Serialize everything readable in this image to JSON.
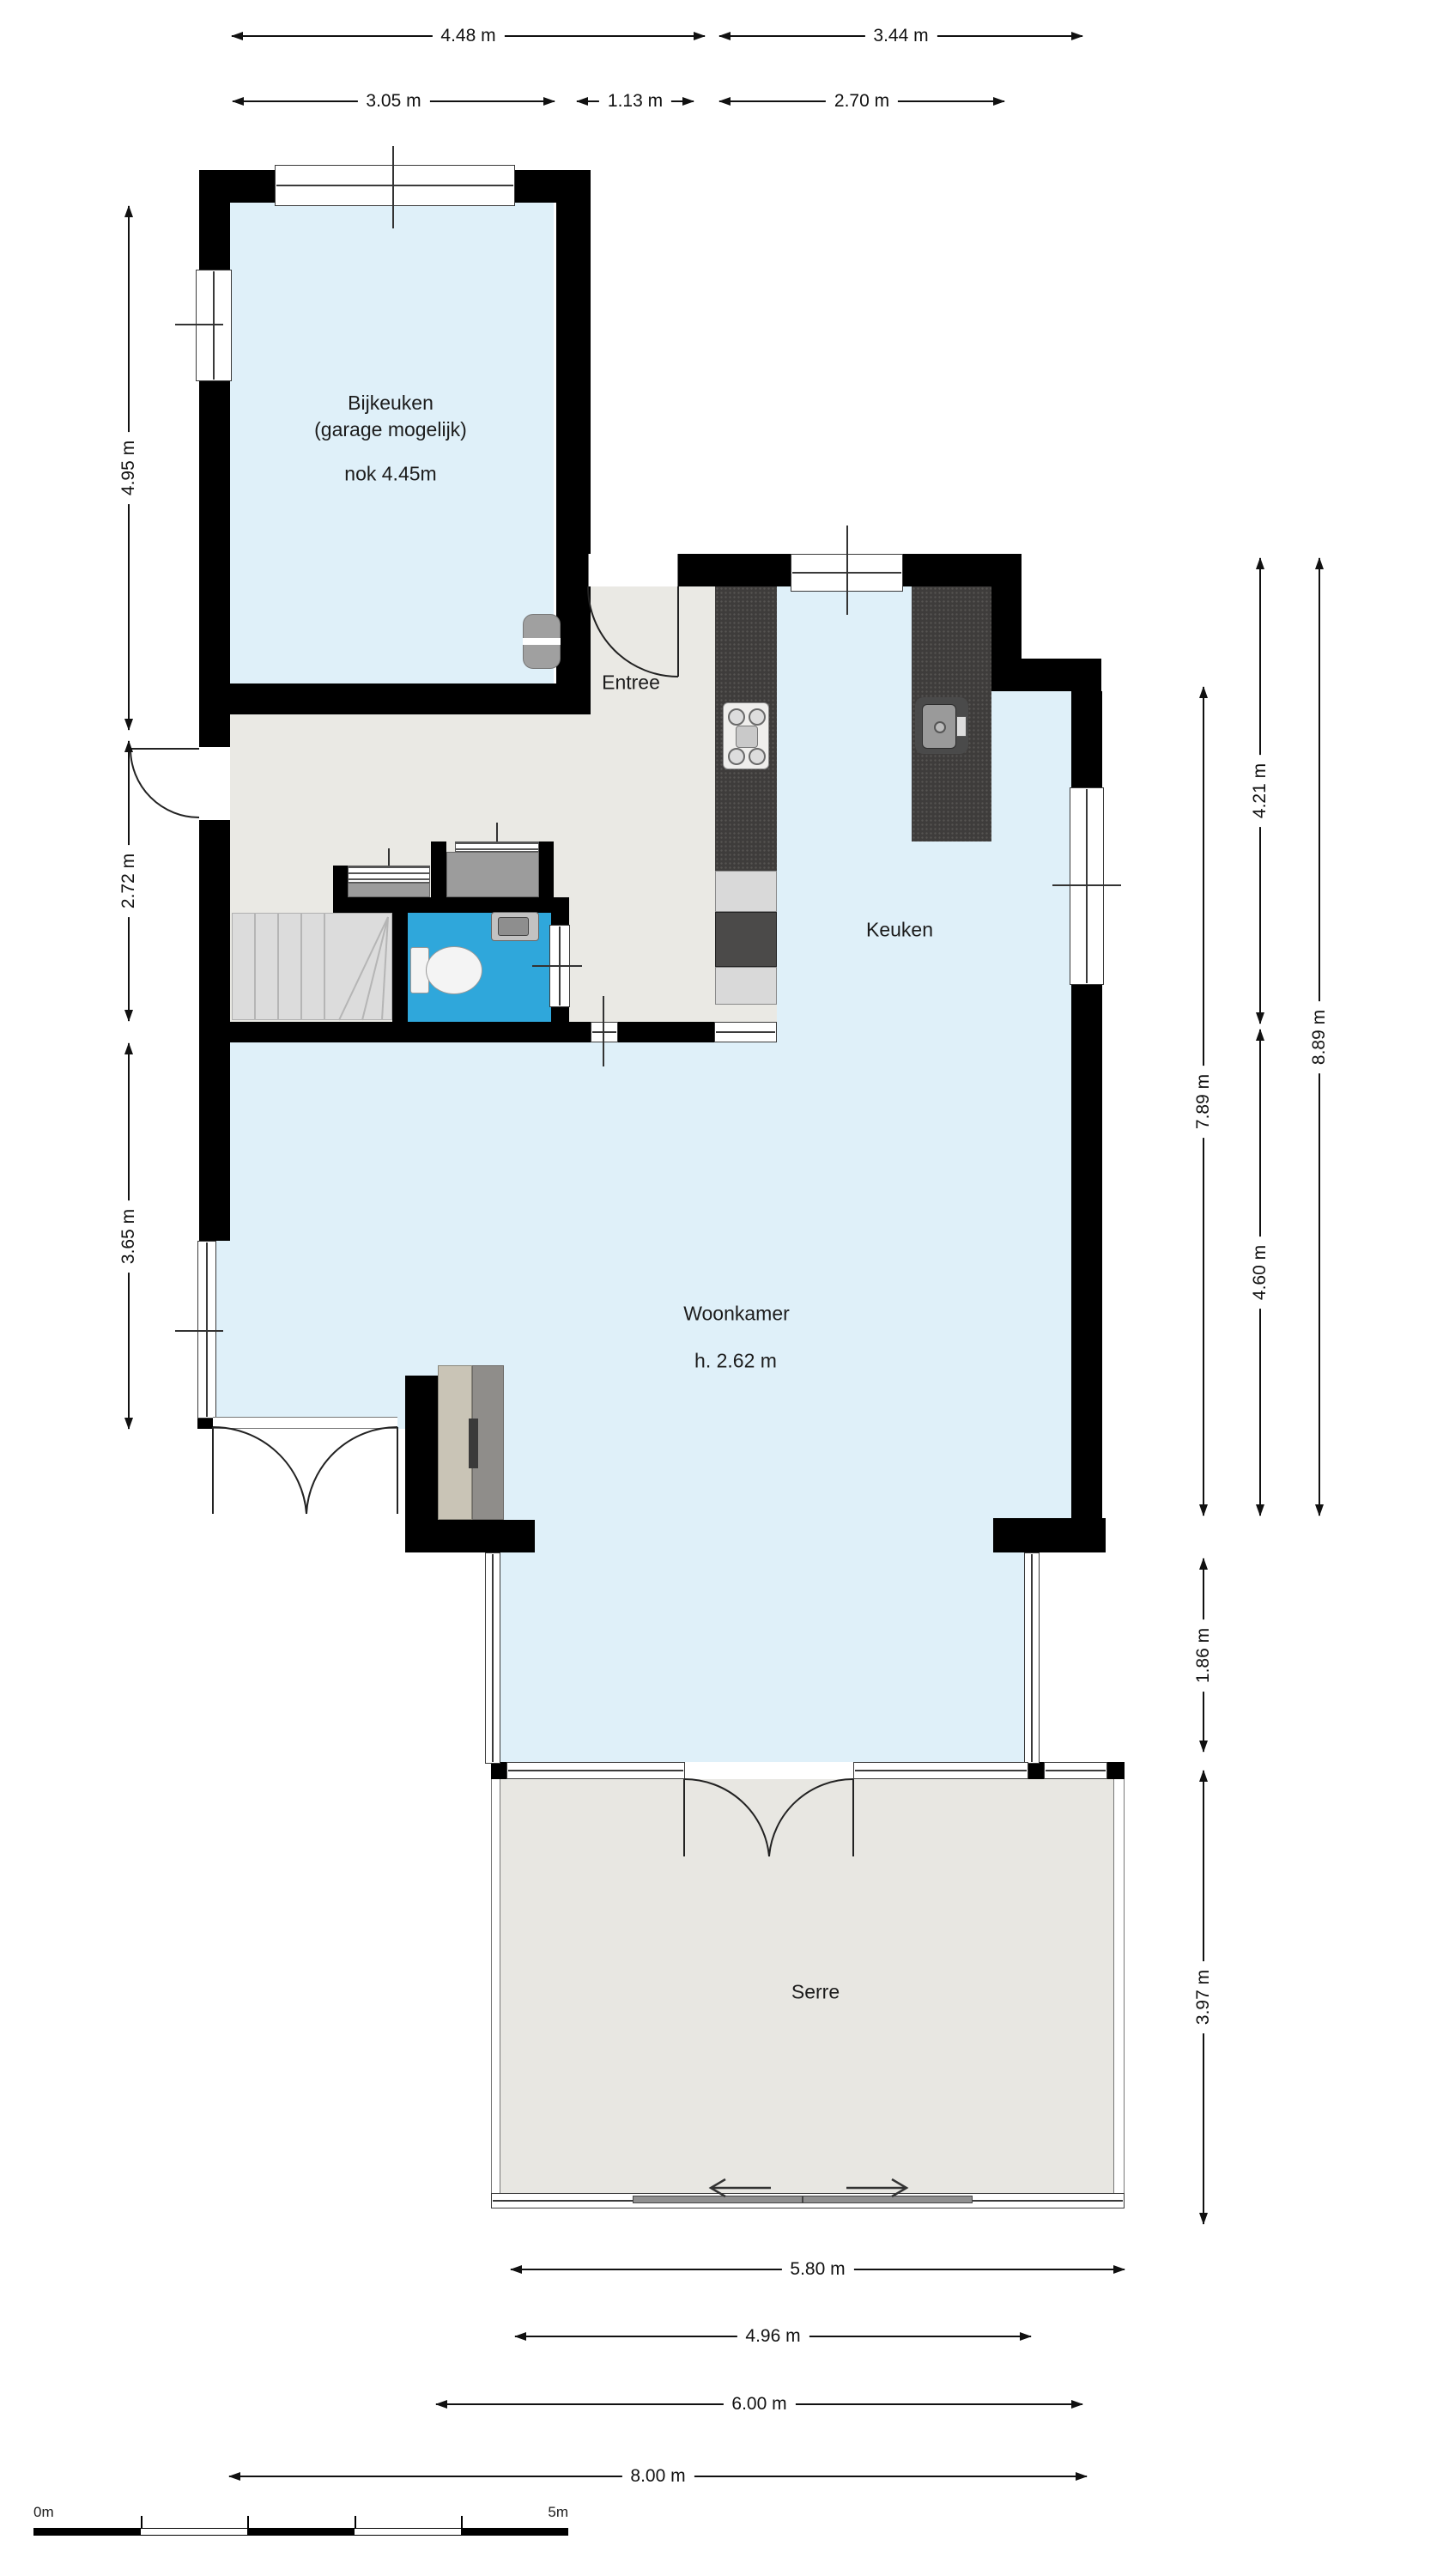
{
  "title": "Begane grond plattegrond",
  "rooms": {
    "bijkeuken": {
      "name": "Bijkeuken",
      "note": "(garage mogelijk)",
      "ridge": "nok 4.45m"
    },
    "entree": {
      "name": "Entree"
    },
    "keuken": {
      "name": "Keuken"
    },
    "woonkamer": {
      "name": "Woonkamer",
      "ceiling": "h. 2.62 m"
    },
    "serre": {
      "name": "Serre"
    }
  },
  "dimensions": {
    "top_outer": [
      "4.48 m",
      "3.44 m"
    ],
    "top_inner": [
      "3.05 m",
      "1.13 m",
      "2.70 m"
    ],
    "left": [
      "4.95 m",
      "2.72 m",
      "3.65 m"
    ],
    "right": [
      "4.21 m",
      "8.89 m",
      "7.89 m",
      "4.60 m",
      "1.86 m",
      "3.97 m"
    ],
    "bottom": [
      "5.80 m",
      "4.96 m",
      "6.00 m",
      "8.00 m"
    ]
  },
  "scale_bar": {
    "start_label": "0m",
    "end_label": "5m"
  },
  "fixtures": [
    "staircase",
    "toilet",
    "washbasin",
    "kitchen-sink",
    "stove",
    "fireplace-cabinet",
    "door-swings",
    "sliding-door"
  ],
  "colors": {
    "wall": "#000000",
    "room_fill": "#dff0f9",
    "hall_fill": "#eae9e4",
    "serre_fill": "#e8e7e2",
    "wc_fill": "#2fa7db",
    "counter": "#3e3c3b",
    "closet": "#9c9c9c",
    "stairs": "#dcdcdc",
    "fireplace_beige": "#c9c4b6",
    "fireplace_gray": "#8f8d8a"
  }
}
